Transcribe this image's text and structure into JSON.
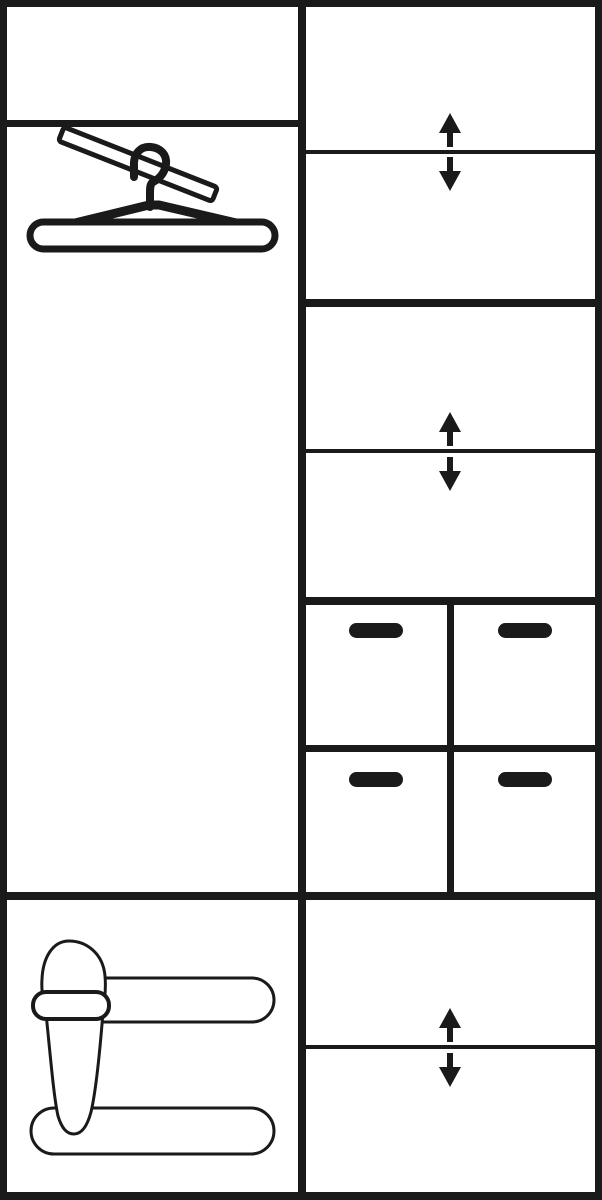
{
  "meta": {
    "title": "Wardrobe interior layout schematic",
    "type": "furniture-line-diagram"
  },
  "colors": {
    "ink": "#1a1a1a",
    "paper": "#ffffff"
  },
  "legend": {
    "hanger_icon": "clothes-hanger-on-rail",
    "shoe_icon": "slipper-on-shoe-rack-rails",
    "arrows_icon": "adjustable-shelf-up-down-arrows",
    "handle_icon": "drawer-pull-handle"
  },
  "sections": {
    "left_column": [
      {
        "name": "top-shelf-compartment",
        "feature": "empty"
      },
      {
        "name": "hanging-rail-compartment",
        "feature": "clothes-hanger-on-rail"
      },
      {
        "name": "shoe-storage-compartment",
        "feature": "slipper-on-shoe-rack-rails"
      }
    ],
    "right_column": [
      {
        "name": "upper-shelf-compartment-1",
        "feature": "adjustable-shelf-up-down-arrows"
      },
      {
        "name": "upper-shelf-compartment-2",
        "feature": "empty"
      },
      {
        "name": "middle-shelf-compartment-1",
        "feature": "adjustable-shelf-up-down-arrows"
      },
      {
        "name": "middle-shelf-compartment-2",
        "feature": "empty"
      },
      {
        "name": "drawer-grid",
        "drawer_count": 4,
        "feature": "drawer-pull-handle"
      },
      {
        "name": "lower-shelf-compartment-1",
        "feature": "adjustable-shelf-up-down-arrows"
      },
      {
        "name": "lower-shelf-compartment-2",
        "feature": "empty"
      }
    ]
  }
}
